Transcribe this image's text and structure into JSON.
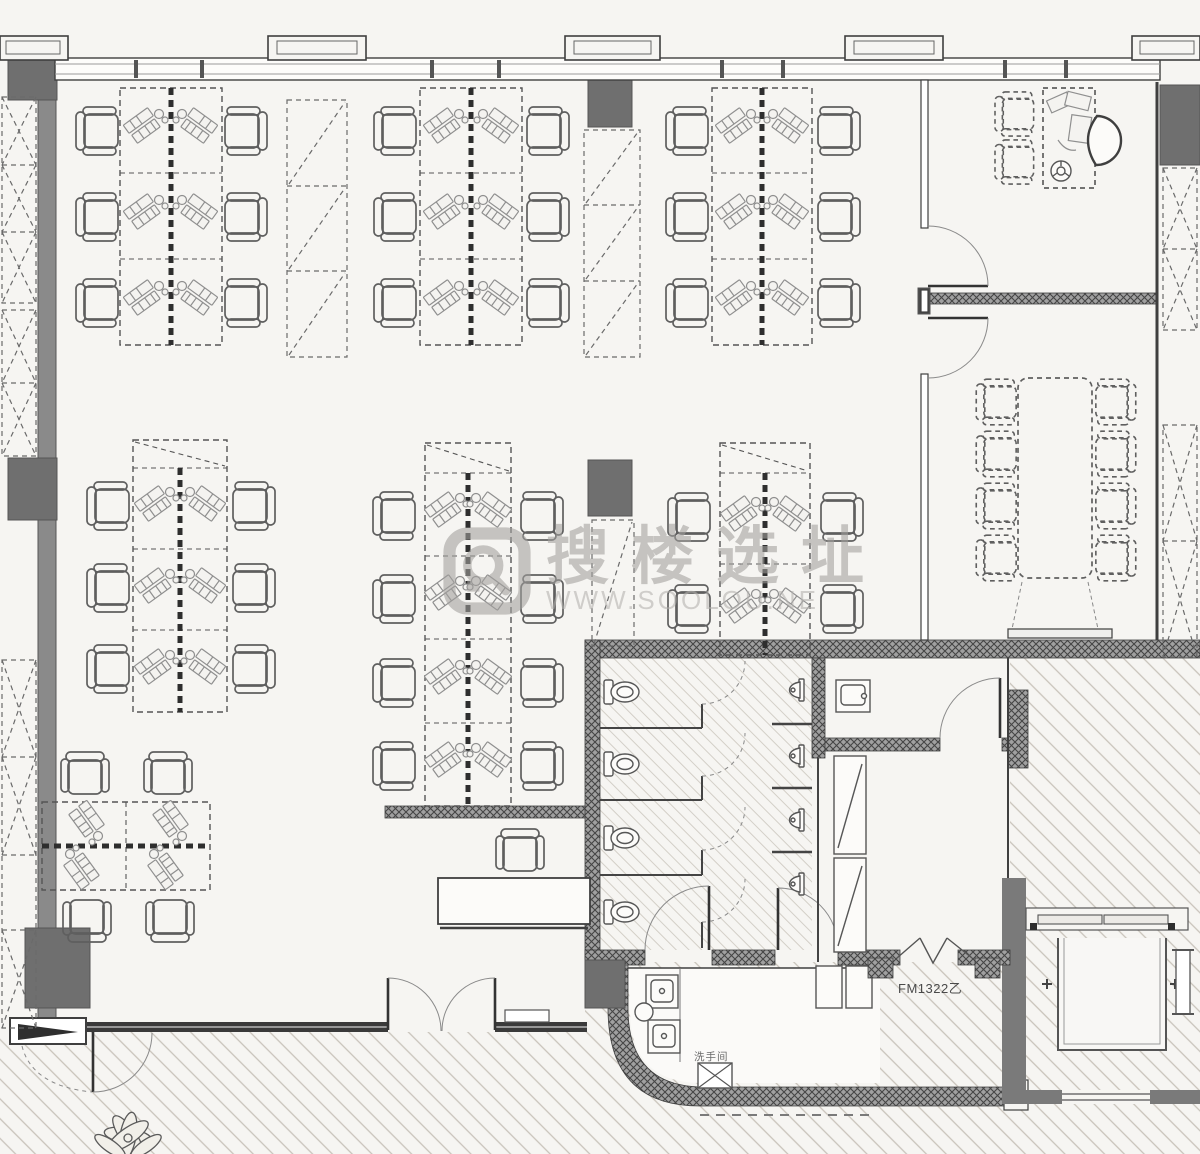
{
  "watermark": {
    "brand": "搜楼选址",
    "url": "WWW.SOOLOU.NE",
    "logo_icon": "magnifier-logo-icon"
  },
  "annotations": {
    "fire_door_label": "FM1322乙",
    "restroom_label": "洗手间"
  },
  "colors": {
    "background": "#f6f5f2",
    "line": "#3f3f3f",
    "wall_fill": "#8a8a8a",
    "column_fill": "#6f6f6f",
    "hatch_line": "#c8c3ba",
    "wall_texture_base": "#a0a0a0",
    "watermark_text": "#a2a09d",
    "watermark_url": "#b3b1ae",
    "dashed_line": "#5a5a5a"
  }
}
